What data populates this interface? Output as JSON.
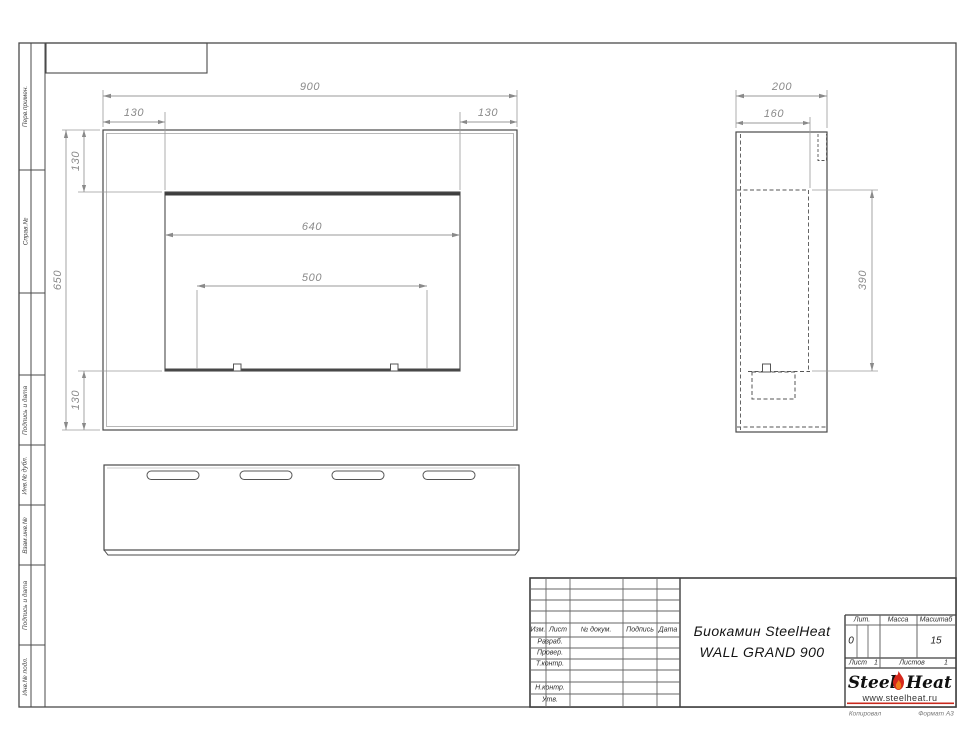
{
  "sheet": {
    "margin_labels": [
      "Перв.примен.",
      "Справ.№",
      "Подпись и дата",
      "Инв.№ дубл.",
      "Взам.инв.№",
      "Подпись и дата",
      "Инв.№ подл."
    ],
    "footer_left": "Копировал",
    "footer_right": "Формат А3"
  },
  "dimensions": {
    "front": {
      "width": "900",
      "inset_left": "130",
      "inset_right": "130",
      "height": "650",
      "top": "130",
      "bottom": "130",
      "opening_width": "640",
      "burner_width": "500"
    },
    "side": {
      "depth": "200",
      "inner_depth": "160",
      "opening_height": "390"
    }
  },
  "title_block": {
    "header_cols": {
      "izm": "Изм.",
      "list": "Лист",
      "doc": "№ докум.",
      "sign": "Подпись",
      "date": "Дата"
    },
    "rows": {
      "razrab": "Разраб.",
      "prover": "Провер.",
      "tkontr": "Т.контр.",
      "nkontr": "Н.контр.",
      "utv": "Утв."
    },
    "title_line1": "Биокамин SteelHeat",
    "title_line2": "WALL GRAND 900",
    "lit_label": "Лит.",
    "lit_value": "0",
    "mass_label": "Масса",
    "scale_label": "Масштаб",
    "scale_value": "15",
    "sheet_label": "Лист",
    "sheet_value": "1",
    "sheets_label": "Листов",
    "sheets_value": "1",
    "brand": {
      "steel": "Steel",
      "heat": "Heat",
      "url": "www.steelheat.ru"
    },
    "colors": {
      "flame_red": "#d5281c",
      "flame_orange": "#f07d1a",
      "rule_red": "#c9281c"
    }
  }
}
